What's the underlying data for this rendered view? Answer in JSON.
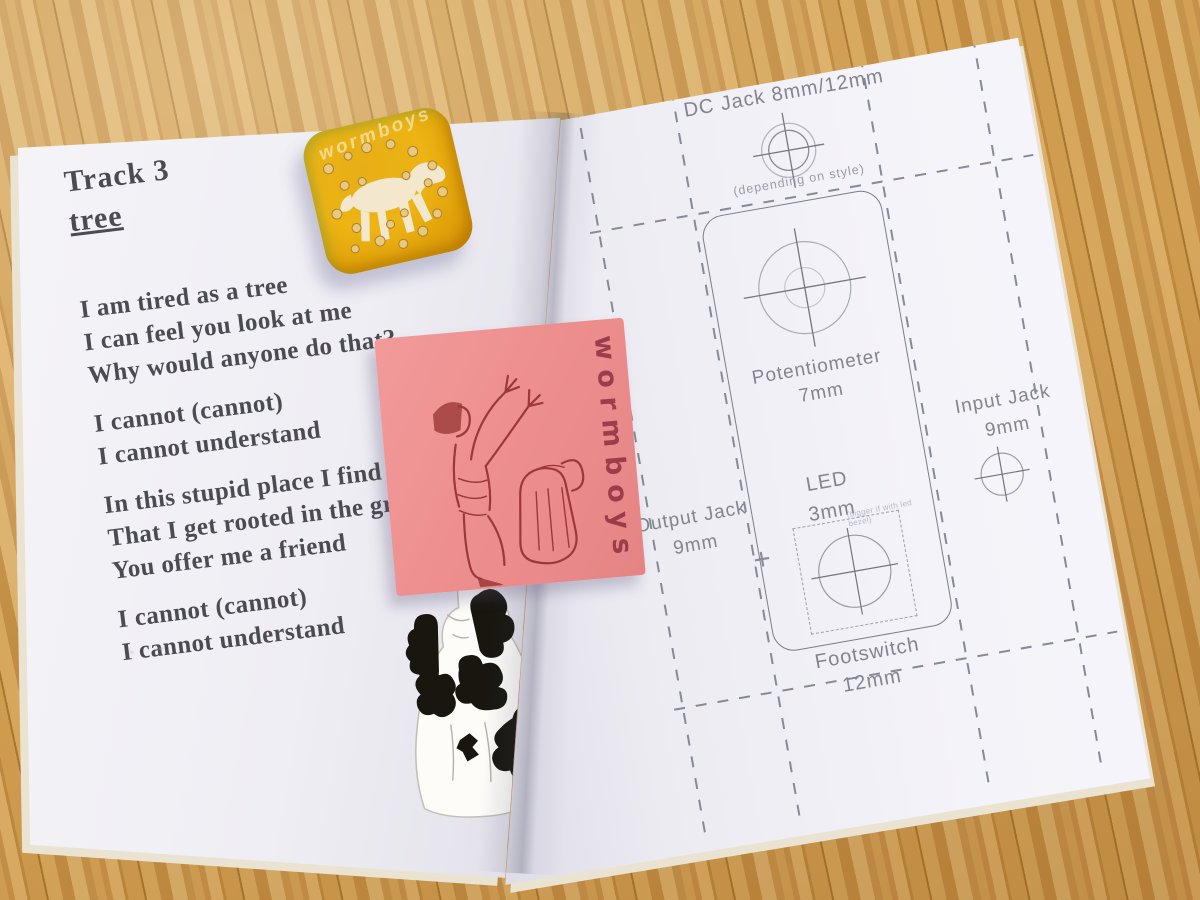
{
  "colors": {
    "wood": "#cd9a4e",
    "wood_dark": "#a9762f",
    "wood_light": "#dcae66",
    "page_white": "#f4f3f8",
    "page_shadow": "#dbdae4",
    "lyrics_ink": "#4b4b52",
    "template_ink": "#84848e",
    "template_line": "#7d7d88",
    "note_pink": "#ee8f8f",
    "sketch_red": "#9c3838",
    "pin_yellow": "#edb414",
    "horse_white": "#f4ead9",
    "rhinestone_gold": "#e9c97e",
    "cow_black": "#18160f"
  },
  "left_page": {
    "track_label": "Track 3",
    "track_title": "tree",
    "stanzas": [
      [
        "I am tired as a tree",
        "I can feel you look at me",
        "Why would anyone do that?"
      ],
      [
        "I cannot (cannot)",
        "I cannot understand"
      ],
      [
        "In this stupid place I find",
        "That I get rooted in the ground",
        "You offer me a friend"
      ],
      [
        "I cannot (cannot)",
        "I cannot understand"
      ]
    ]
  },
  "right_page": {
    "dc_jack_label": "DC Jack 8mm/12mm",
    "dc_jack_note": "(depending on style)",
    "potentiometer_label": "Potentiometer",
    "potentiometer_size": "7mm",
    "led_label": "LED",
    "led_size": "3mm",
    "led_note": "(bigger if with led bezel)",
    "output_jack_label": "Output Jack",
    "output_jack_size": "9mm",
    "input_jack_label": "Input Jack",
    "input_jack_size": "9mm",
    "footswitch_label": "Footswitch",
    "footswitch_size": "12mm"
  },
  "sticky_note": {
    "text": "wormboys"
  },
  "pin_badge": {
    "text": "wormboys"
  }
}
